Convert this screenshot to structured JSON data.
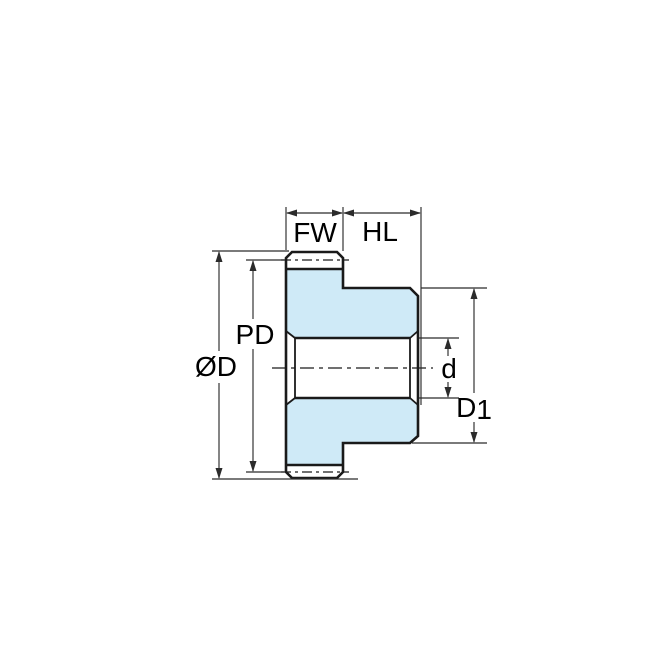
{
  "drawing": {
    "subject": "spur gear with hub - side cross-section technical drawing",
    "labels": {
      "face_width": "FW",
      "hub_length": "HL",
      "pitch_diameter": "PD",
      "outside_diameter": "ØD",
      "bore_diameter": "d",
      "hub_diameter_main": "D",
      "hub_diameter_sub": "1"
    },
    "colors": {
      "part_fill": "#cfeaf7",
      "outline": "#1a1a1a",
      "dimension_lines": "#2b2b2b",
      "text": "#000000",
      "background": "#ffffff"
    }
  }
}
